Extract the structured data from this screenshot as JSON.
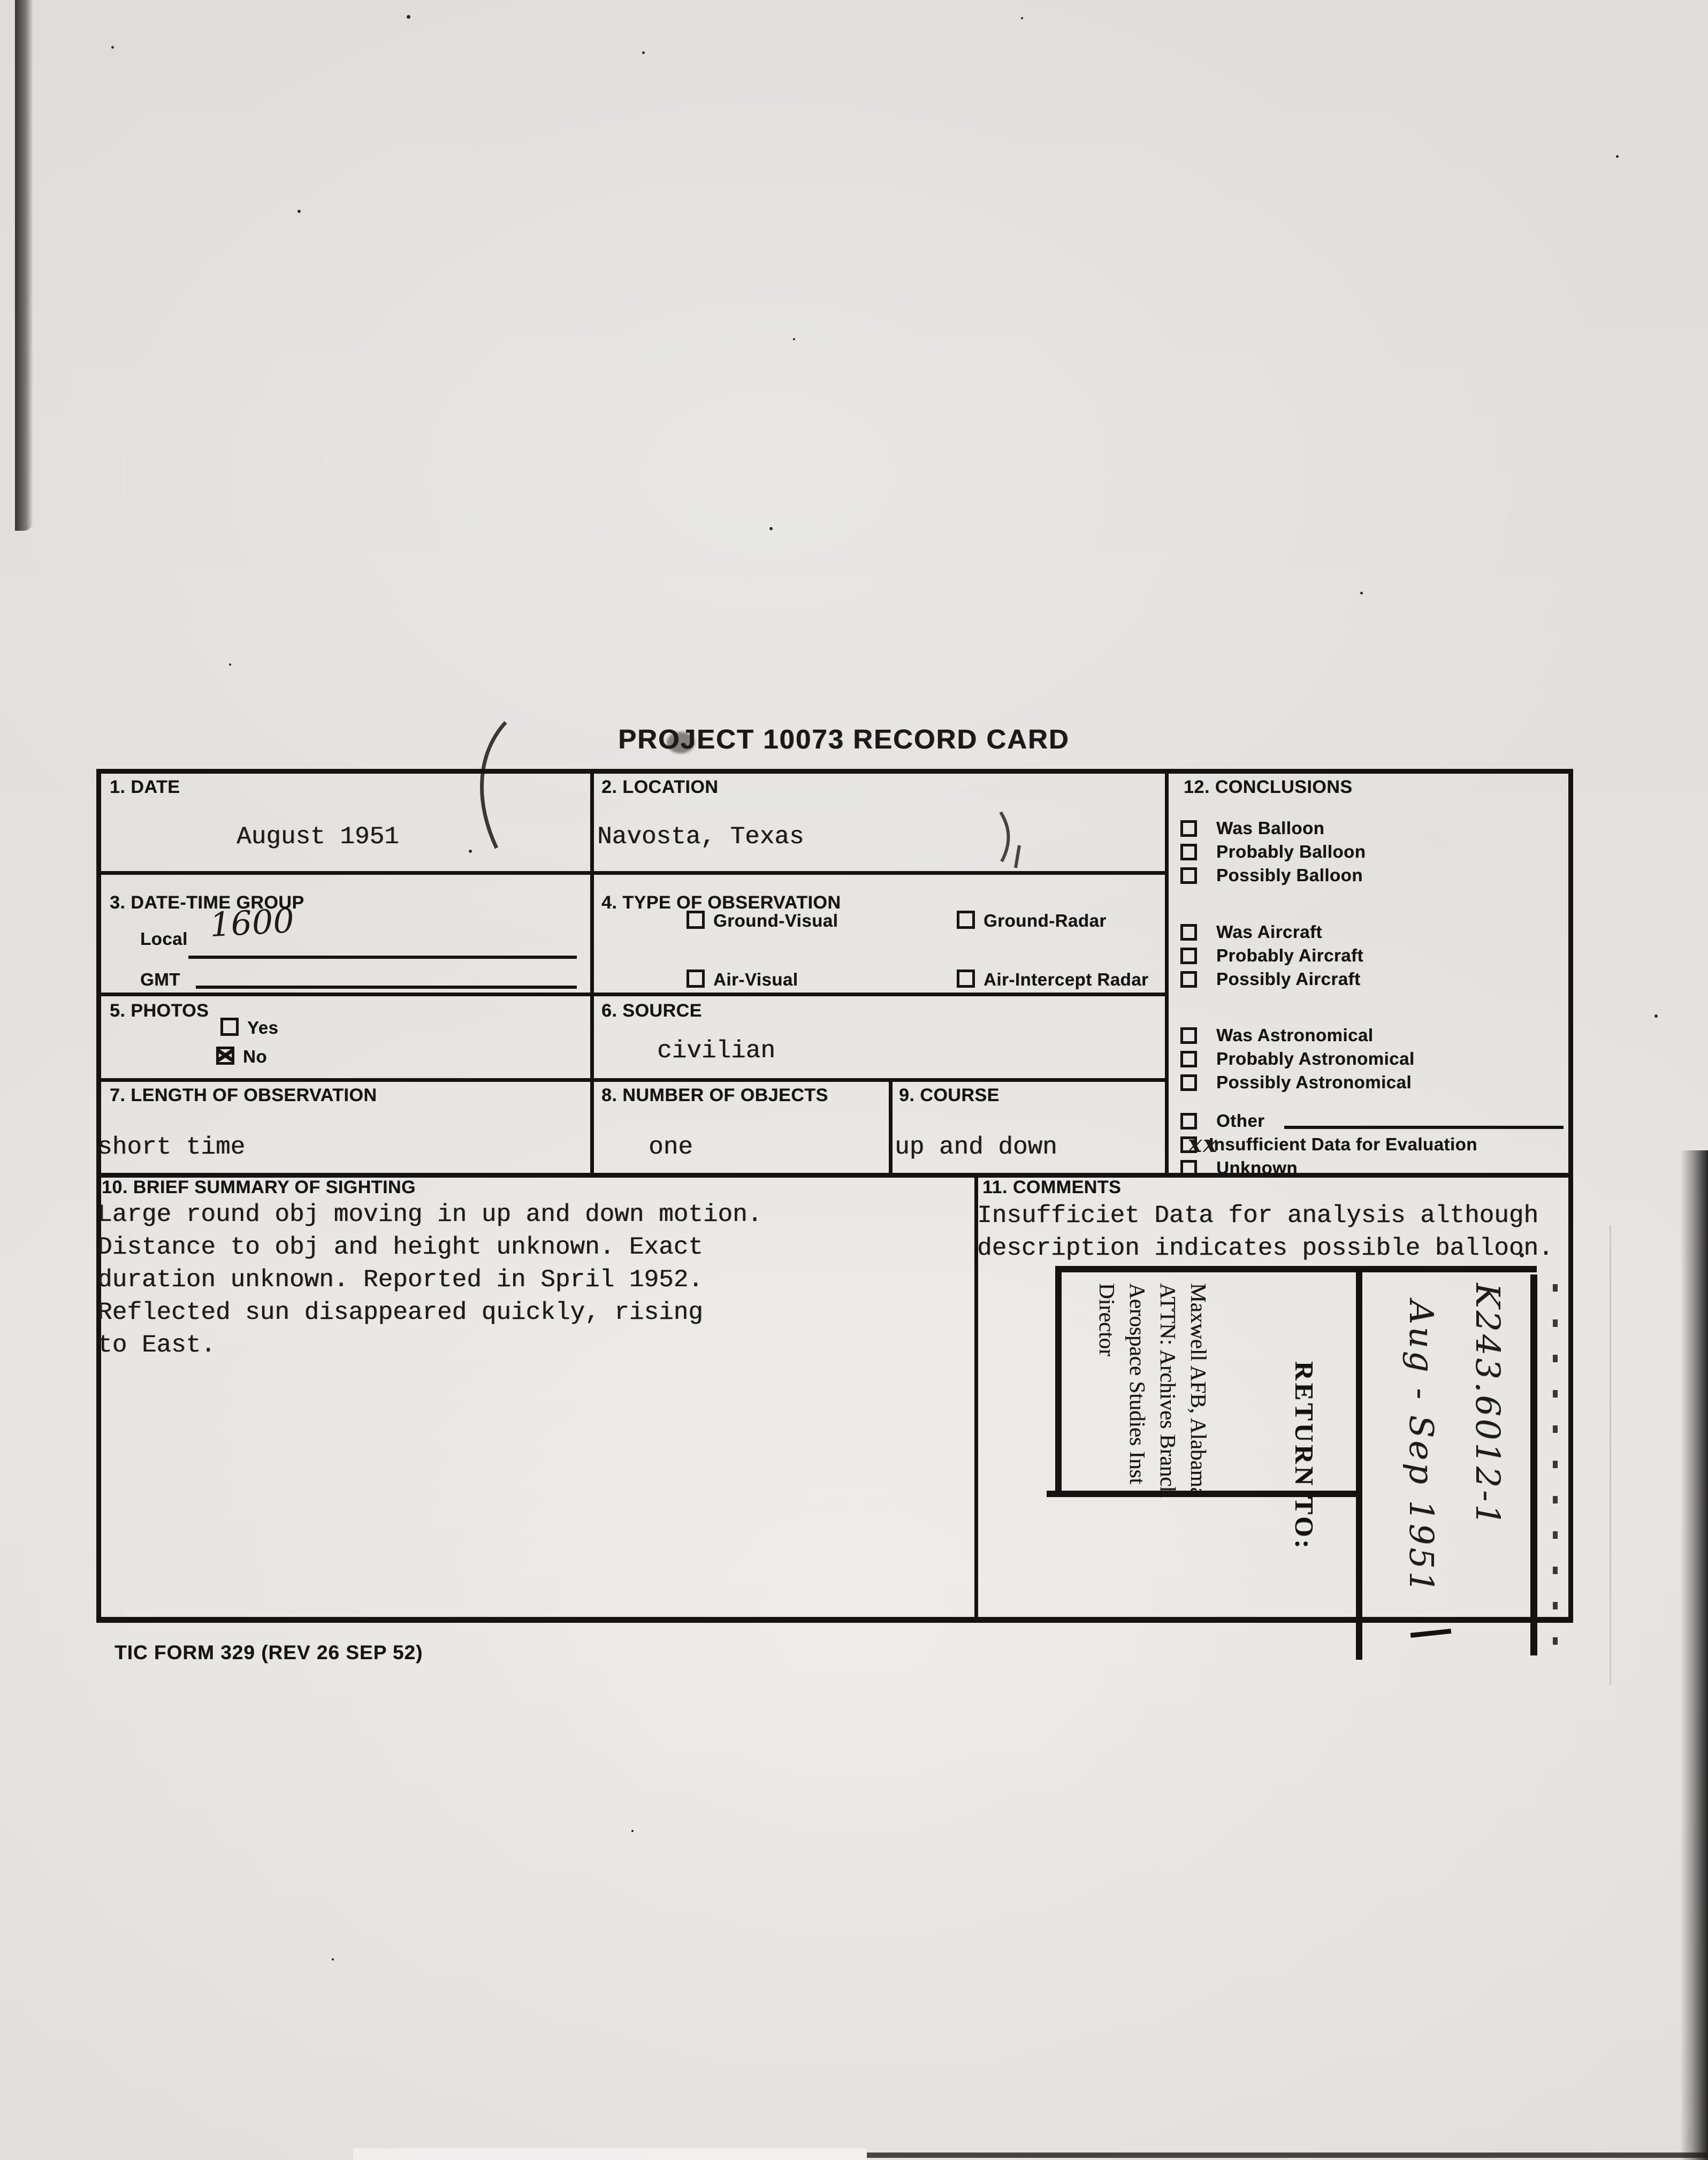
{
  "colors": {
    "paper": "#e8e6e2",
    "ink": "#1b1a19"
  },
  "title": "PROJECT 10073 RECORD CARD",
  "form_number": "TIC FORM 329 (REV 26 SEP 52)",
  "fields": {
    "date": {
      "label": "1. DATE",
      "value": "August 1951"
    },
    "location": {
      "label": "2. LOCATION",
      "value": "Navosta, Texas"
    },
    "date_time_group": {
      "label": "3. DATE-TIME GROUP",
      "local_label": "Local",
      "local_value": "1600",
      "gmt_label": "GMT",
      "gmt_value": ""
    },
    "type_of_observation": {
      "label": "4. TYPE OF OBSERVATION",
      "options": [
        {
          "label": "Ground-Visual",
          "checked": false
        },
        {
          "label": "Ground-Radar",
          "checked": false
        },
        {
          "label": "Air-Visual",
          "checked": false
        },
        {
          "label": "Air-Intercept Radar",
          "checked": false
        }
      ]
    },
    "photos": {
      "label": "5. PHOTOS",
      "options": [
        {
          "label": "Yes",
          "checked": false
        },
        {
          "label": "No",
          "checked": true
        }
      ]
    },
    "source": {
      "label": "6. SOURCE",
      "value": "civilian"
    },
    "length_of_observation": {
      "label": "7. LENGTH OF OBSERVATION",
      "value": "short time"
    },
    "number_of_objects": {
      "label": "8. NUMBER OF OBJECTS",
      "value": "one"
    },
    "course": {
      "label": "9. COURSE",
      "value": "up and down"
    },
    "brief_summary": {
      "label": "10. BRIEF SUMMARY OF SIGHTING",
      "lines": [
        "Large round obj moving in up and down motion.",
        "Distance to obj and height unknown. Exact",
        "duration unknown. Reported in Spril 1952.",
        "Reflected sun disappeared quickly, rising",
        "to East."
      ]
    },
    "comments": {
      "label": "11. COMMENTS",
      "lines": [
        "Insufficiet Data for analysis although",
        "description indicates possible balloon."
      ]
    },
    "conclusions": {
      "label": "12. CONCLUSIONS",
      "groups": [
        [
          {
            "label": "Was Balloon",
            "checked": false
          },
          {
            "label": "Probably Balloon",
            "checked": false
          },
          {
            "label": "Possibly Balloon",
            "checked": false
          }
        ],
        [
          {
            "label": "Was Aircraft",
            "checked": false
          },
          {
            "label": "Probably Aircraft",
            "checked": false
          },
          {
            "label": "Possibly Aircraft",
            "checked": false
          }
        ],
        [
          {
            "label": "Was Astronomical",
            "checked": false
          },
          {
            "label": "Probably Astronomical",
            "checked": false
          },
          {
            "label": "Possibly Astronomical",
            "checked": false
          }
        ],
        [
          {
            "label": "Other",
            "checked": false,
            "other_line": true
          },
          {
            "label": "Insufficient Data for Evaluation",
            "checked": false,
            "mark": "xx"
          },
          {
            "label": "Unknown",
            "checked": false
          }
        ]
      ]
    }
  },
  "stamp": {
    "return_to_label": "RETURN TO:",
    "address_lines": [
      "Director",
      "Aerospace Studies Inst",
      "ATTN: Archives Branch",
      "Maxwell AFB, Alabama"
    ],
    "handwritten_lines": [
      "K243.6012-1",
      "Aug - Sep 1951"
    ]
  }
}
